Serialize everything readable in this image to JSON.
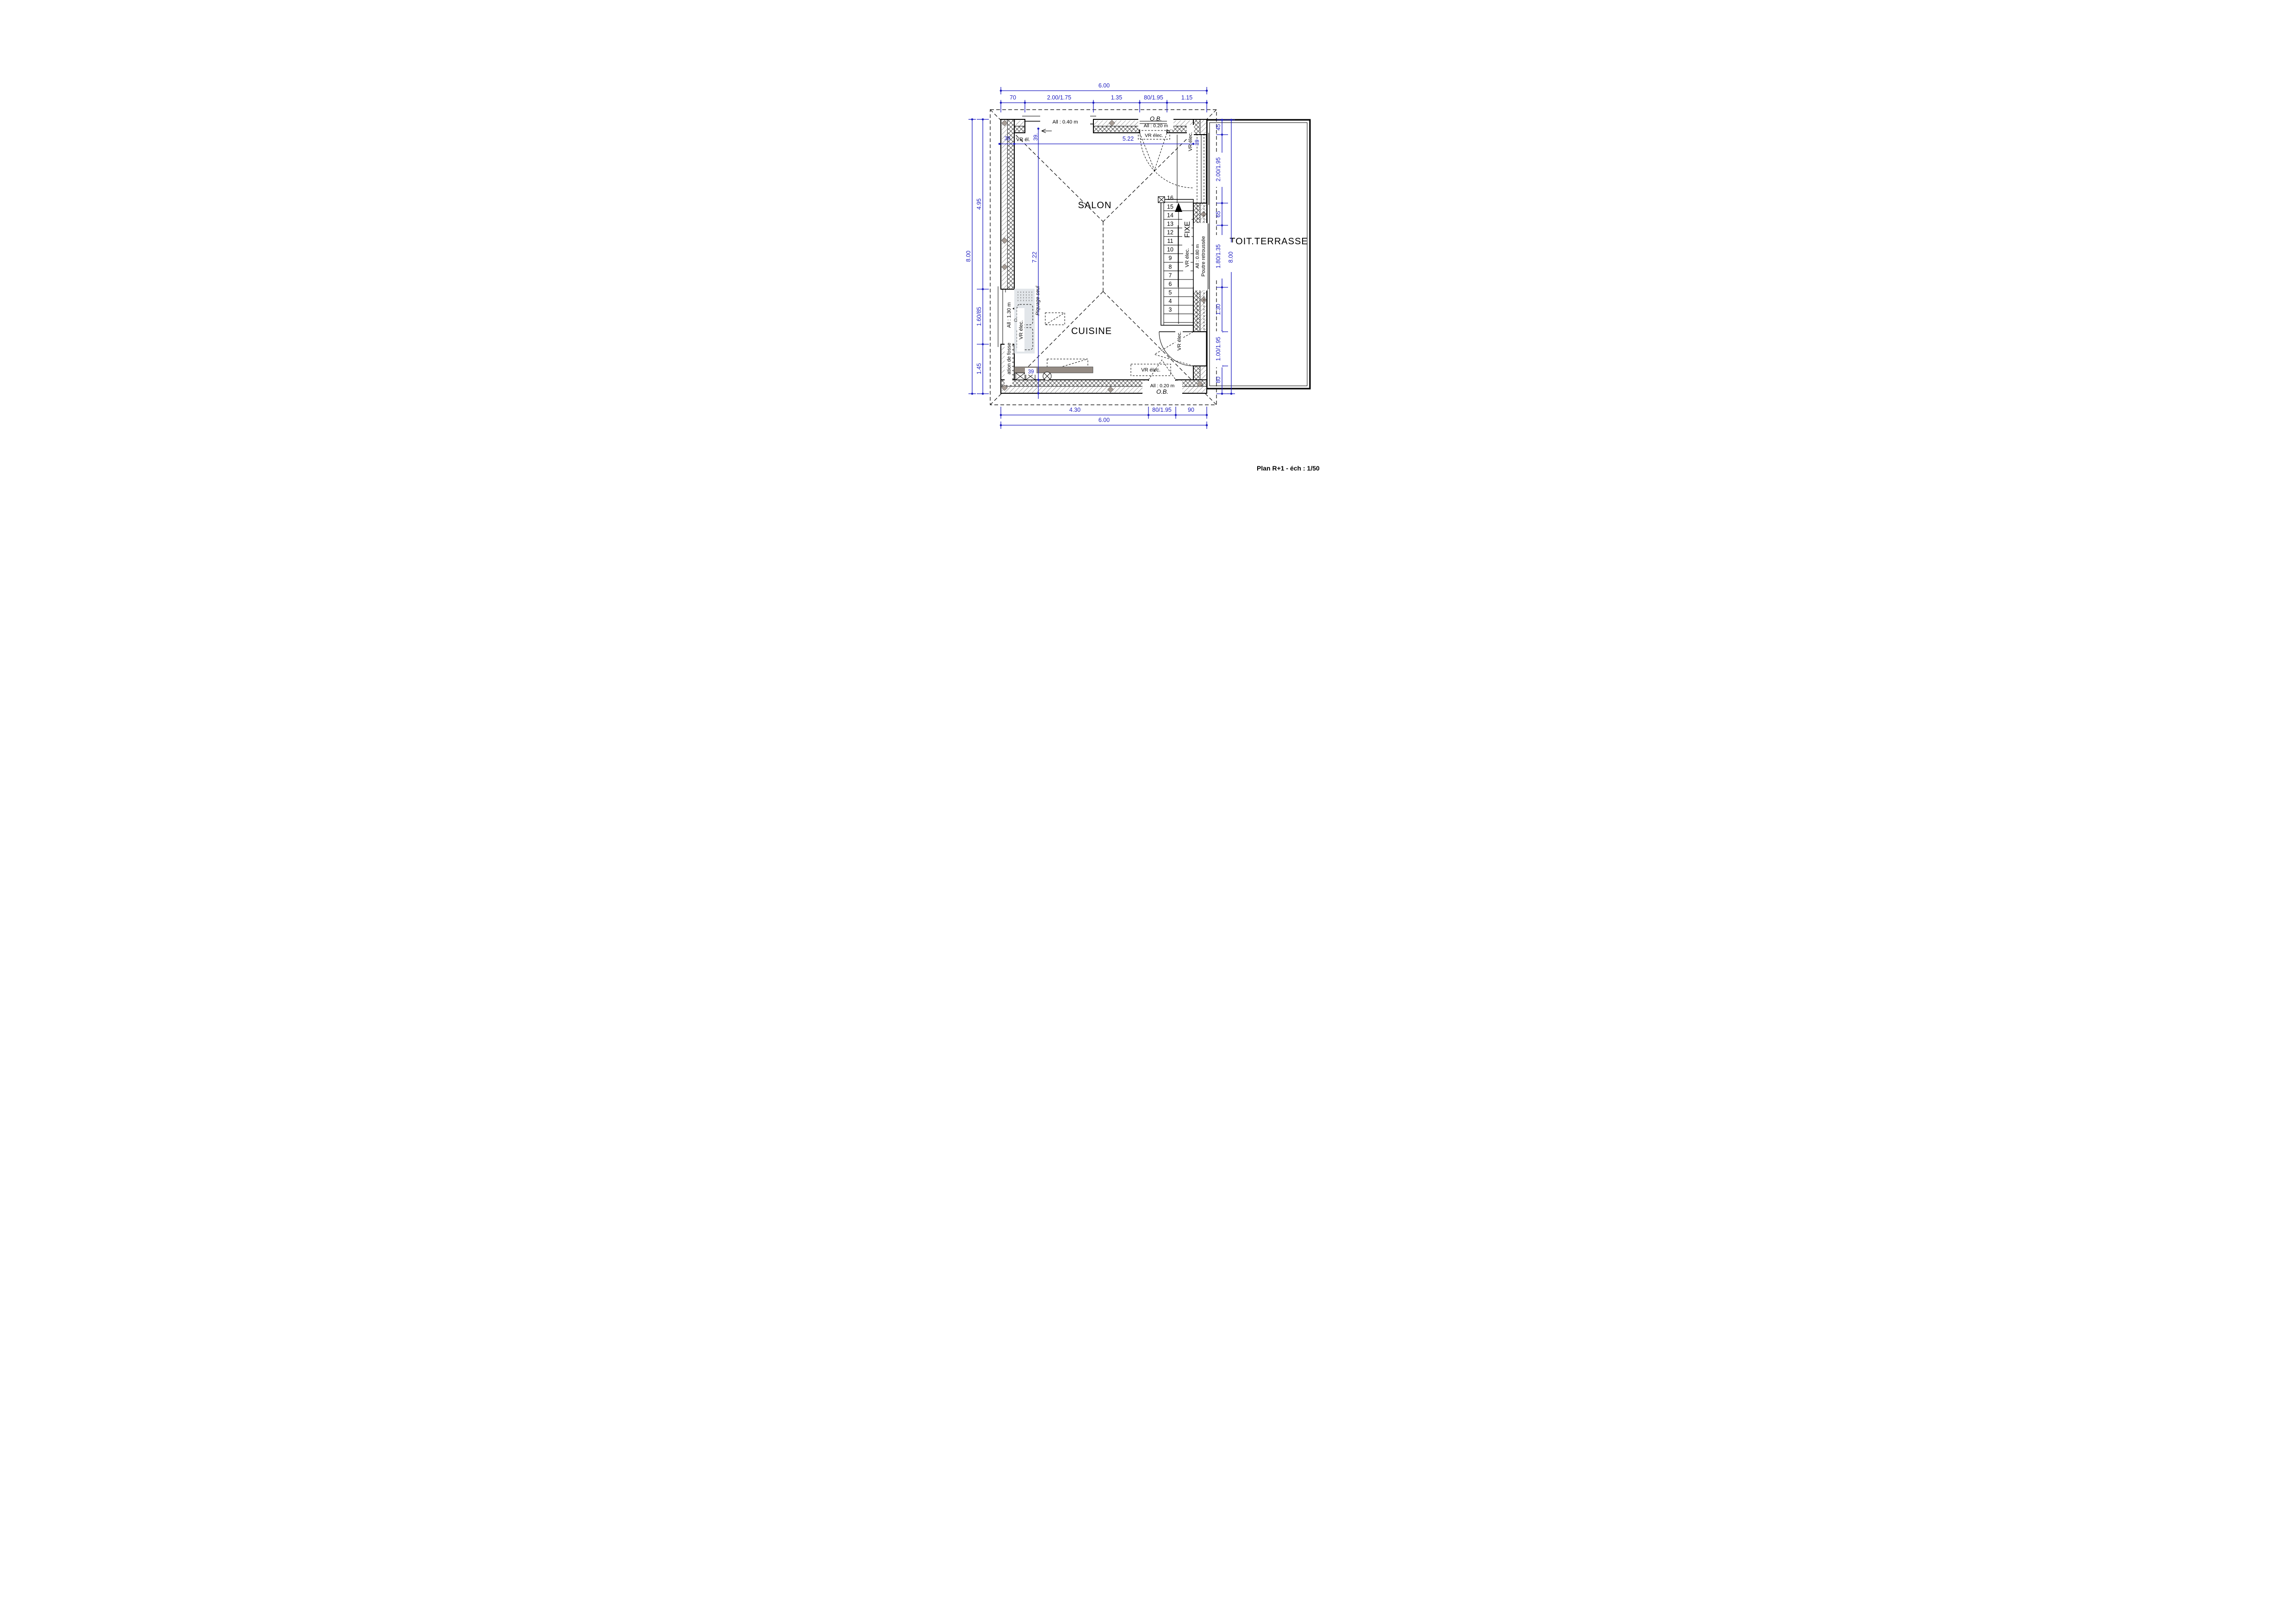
{
  "title": "Plan R+1 - éch : 1/50",
  "colors": {
    "dimension_blue": "#1d1dc0",
    "drawing_black": "#000000",
    "accent_gray": "#a89e97",
    "sink_gray": "#ccd3da",
    "counter_gray": "#948b84"
  },
  "rooms": {
    "salon": "SALON",
    "cuisine": "CUISINE",
    "terrasse": "TOIT.TERRASSE"
  },
  "dims": {
    "top": {
      "overall": "6.00",
      "segments": [
        "70",
        "2.00/1.75",
        "1.35",
        "80/1.95",
        "1.15"
      ]
    },
    "bottom": {
      "overall": "6.00",
      "segments": [
        "4.30",
        "80/1.95",
        "90"
      ]
    },
    "left": {
      "overall": "8.00",
      "segments": [
        "4.95",
        "1.60/85",
        "1.45"
      ]
    },
    "right": {
      "overall": "8.00",
      "segments": [
        "45",
        "2.00/1.95",
        "65",
        "1.80/1.35",
        "1.30",
        "1.00/1.95",
        "80"
      ]
    },
    "interior": {
      "width": "5.22",
      "height": "7.22",
      "wall_left": "39",
      "wall_top": "39.",
      "wall_right": "39",
      "wall_bottom": "39"
    }
  },
  "labels": {
    "allege_040": "All : 0.40 m",
    "allege_020": "All : 0.20 m",
    "allege_130": "All : 1.30 m",
    "allege_080": "All : 0.80 m",
    "ob": "O.B.",
    "vr_elec": "VR élec.",
    "vr_elec_clip": "VR él.",
    "piquage": "Piquage seul",
    "fosse": "ation de fosse",
    "poutre": "Poutre retroussée",
    "fixe": "FIXE"
  },
  "stairs": {
    "steps": [
      "3",
      "4",
      "5",
      "6",
      "7",
      "8",
      "9",
      "10",
      "11",
      "12",
      "13",
      "14",
      "15",
      "16"
    ]
  }
}
